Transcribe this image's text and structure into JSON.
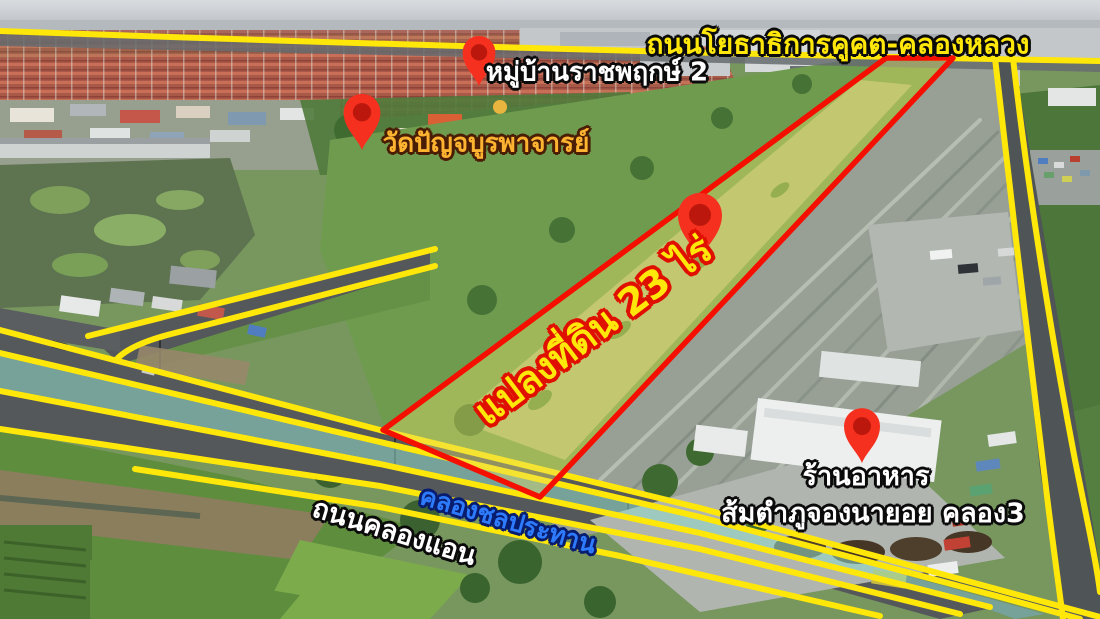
{
  "labels": {
    "top_road": "ถนนโยธาธิการคูคต-คลองหลวง",
    "village": "หมู่บ้านราชพฤกษ์ 2",
    "temple": "วัดปัญจบูรพาจารย์",
    "land_plot": "แปลงที่ดิน 23 ไร่",
    "canal": "คลองชลประทาน",
    "bottom_road": "ถนนคลองแอน",
    "restaurant_line1": "ร้านอาหาร",
    "restaurant_line2": "ส้มตำภูจองนายอย คลอง3"
  },
  "land_plot": {
    "area": "23 ไร่"
  },
  "pins": [
    {
      "icon": "location-pin",
      "points_to": "หมู่บ้านราชพฤกษ์ 2"
    },
    {
      "icon": "location-pin",
      "points_to": "วัดปัญจบูรพาจารย์"
    },
    {
      "icon": "location-pin",
      "points_to": "แปลงที่ดิน 23 ไร่"
    },
    {
      "icon": "location-pin",
      "points_to": "ร้านอาหาร ส้มตำภูจองนายอย คลอง3"
    }
  ],
  "colors": {
    "road_line": "#ffe70a",
    "plot_outline": "#f50f00",
    "plot_fill_tint": "#e4de69",
    "canal_highlight": "#8fd8cb",
    "pin_red": "#f5301f",
    "label_yellow": "#ffe70a",
    "label_gold": "#ffb431",
    "label_white": "#ffffff",
    "label_blue": "#2e7bfe"
  }
}
